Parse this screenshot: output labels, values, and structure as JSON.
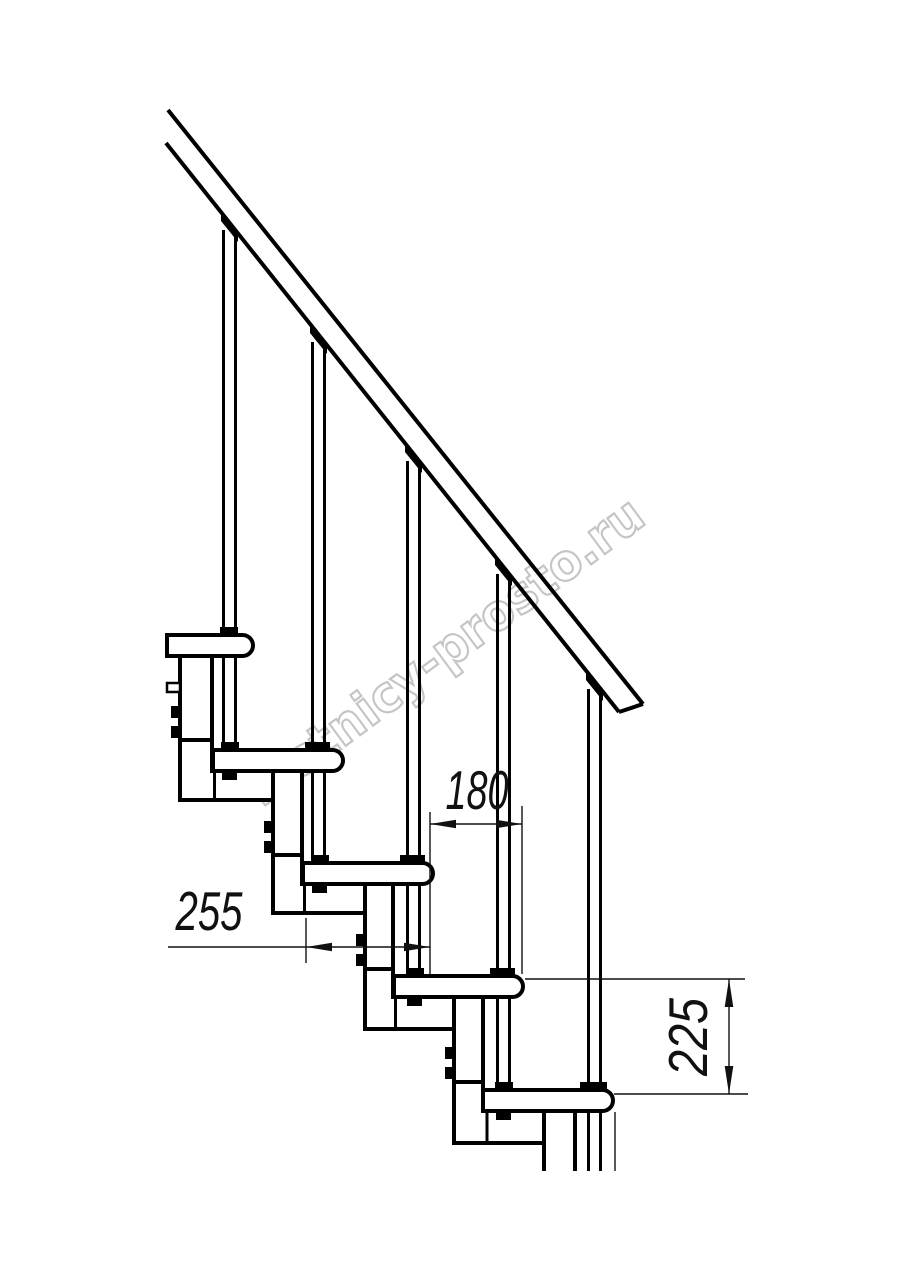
{
  "page": {
    "background": "#ffffff"
  },
  "watermark": {
    "text": "lestnicy-prosto.ru",
    "color": "#c5c5c5",
    "angle_deg": -36.5,
    "instances": 2
  },
  "drawing": {
    "subject": "modular staircase side elevation",
    "line_color": "#000000",
    "tread_count": 5,
    "baluster_count": 5,
    "has_handrail": true
  },
  "dimensions": {
    "d180": {
      "value": "180",
      "orientation": "horizontal"
    },
    "d255": {
      "value": "255",
      "orientation": "horizontal"
    },
    "d225": {
      "value": "225",
      "orientation": "vertical"
    }
  }
}
